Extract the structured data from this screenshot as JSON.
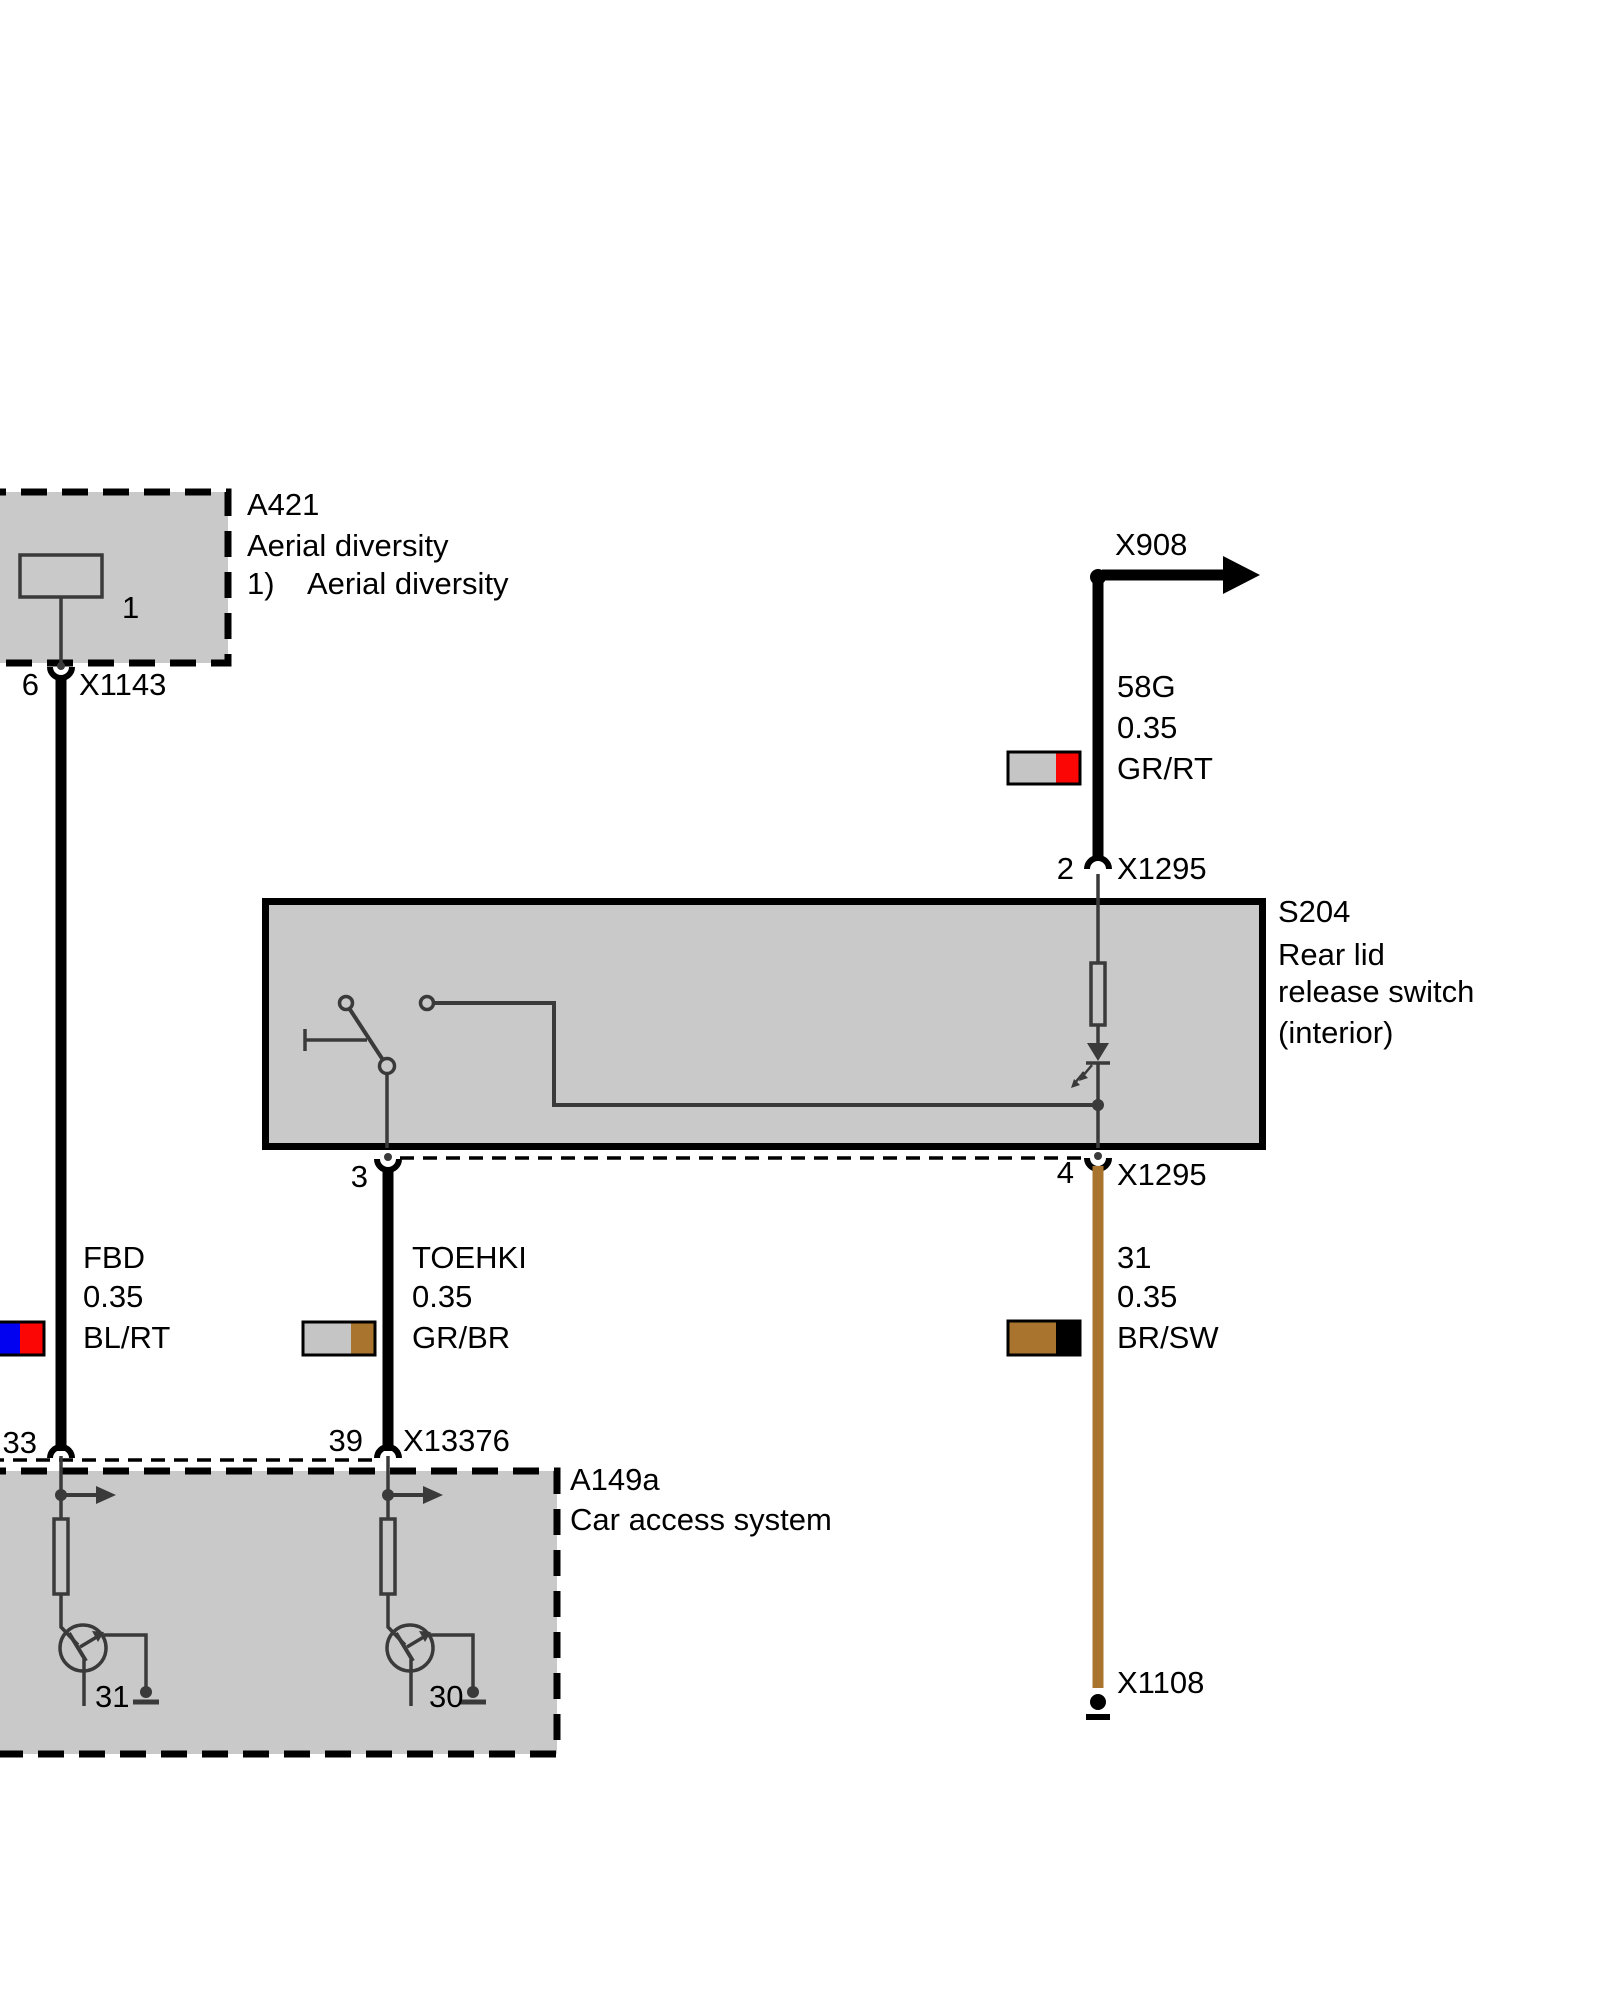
{
  "colors": {
    "background": "#ffffff",
    "box_fill": "#c9c9c9",
    "line_dark": "#3a3a3a",
    "black": "#000000",
    "brown_wire": "#a9742e",
    "swatch_gray": "#c5c5c5",
    "swatch_red": "#fb0505",
    "swatch_blue": "#0202f0",
    "swatch_brown": "#a9742e",
    "swatch_black": "#000000"
  },
  "components": {
    "a421": {
      "id": "A421",
      "desc": "Aerial diversity",
      "footnote_marker": "1)",
      "footnote_text": "Aerial diversity",
      "inner_pin": "1"
    },
    "s204": {
      "id": "S204",
      "line1": "Rear lid",
      "line2": "release switch",
      "line3": "(interior)"
    },
    "a149a": {
      "id": "A149a",
      "desc": "Car access system",
      "gnd_pin_left": "31",
      "gnd_pin_right": "30"
    }
  },
  "connectors": {
    "x1143": {
      "pin": "6",
      "label": "X1143"
    },
    "x908": {
      "label": "X908"
    },
    "x1295_top": {
      "pin": "2",
      "label": "X1295"
    },
    "x1295_bot": {
      "pin_left": "3",
      "pin_right": "4",
      "label": "X1295"
    },
    "x13376": {
      "pin_left": "33",
      "pin_right": "39",
      "label": "X13376"
    },
    "x1108": {
      "label": "X1108"
    }
  },
  "wires": {
    "fbd": {
      "name": "FBD",
      "size": "0.35",
      "code": "BL/RT",
      "c1": "#0202f0",
      "c2": "#fb0505"
    },
    "w58g": {
      "name": "58G",
      "size": "0.35",
      "code": "GR/RT",
      "c1": "#c5c5c5",
      "c2": "#fb0505"
    },
    "toehki": {
      "name": "TOEHKI",
      "size": "0.35",
      "code": "GR/BR",
      "c1": "#c5c5c5",
      "c2": "#a9742e"
    },
    "w31": {
      "name": "31",
      "size": "0.35",
      "code": "BR/SW",
      "c1": "#a9742e",
      "c2": "#000000"
    }
  }
}
